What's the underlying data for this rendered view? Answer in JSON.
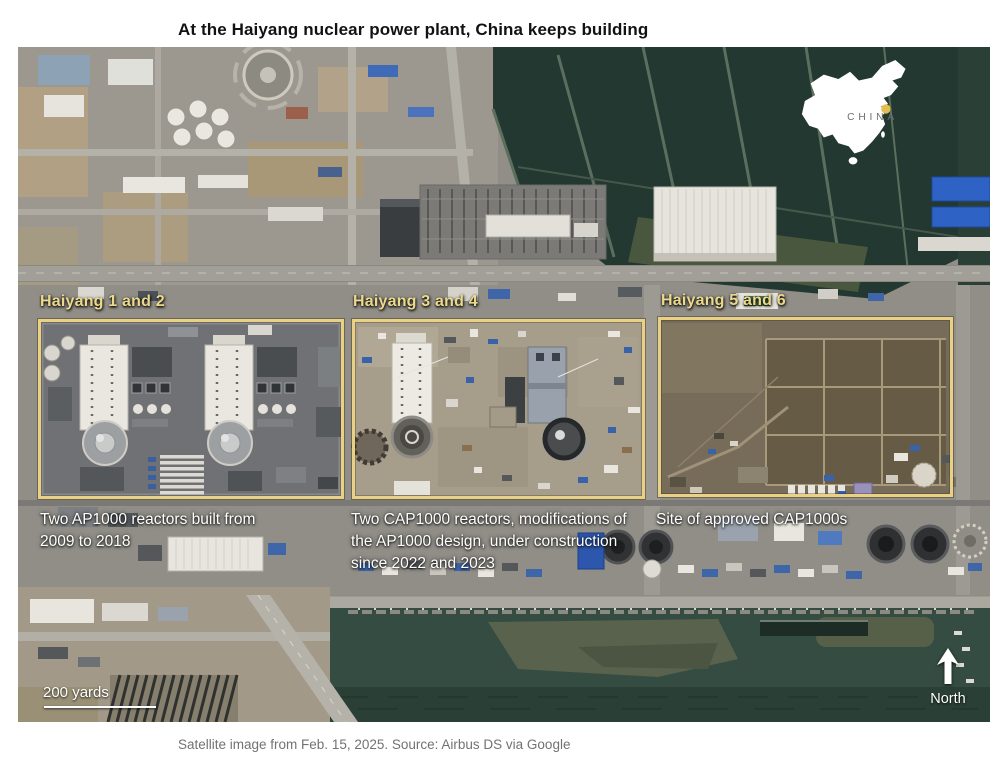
{
  "title": "At the Haiyang nuclear power plant, China keeps building",
  "sites": [
    {
      "label": "Haiyang 1 and 2",
      "caption": "Two AP1000 reactors built from 2009 to 2018"
    },
    {
      "label": "Haiyang 3 and 4",
      "caption": "Two CAP1000 reactors, modifications of the AP1000 design, under construction since 2022 and 2023"
    },
    {
      "label": "Haiyang 5 and 6",
      "caption": "Site of approved CAP1000s"
    }
  ],
  "map_inset": {
    "country_label": "CHINA",
    "marker_color": "#e2be50"
  },
  "scale_bar": {
    "label": "200 yards"
  },
  "compass": {
    "label": "North"
  },
  "credit": "Satellite image from Feb. 15, 2025. Source: Airbus DS via Google",
  "colors": {
    "annotation_yellow": "#e8d084",
    "label_yellow": "#ecd98d",
    "caption_white": "#ffffff",
    "credit_gray": "#727272",
    "sea_green": "#354c42",
    "pond_dark": "#223830"
  },
  "icons": {
    "north_arrow": "↑"
  }
}
